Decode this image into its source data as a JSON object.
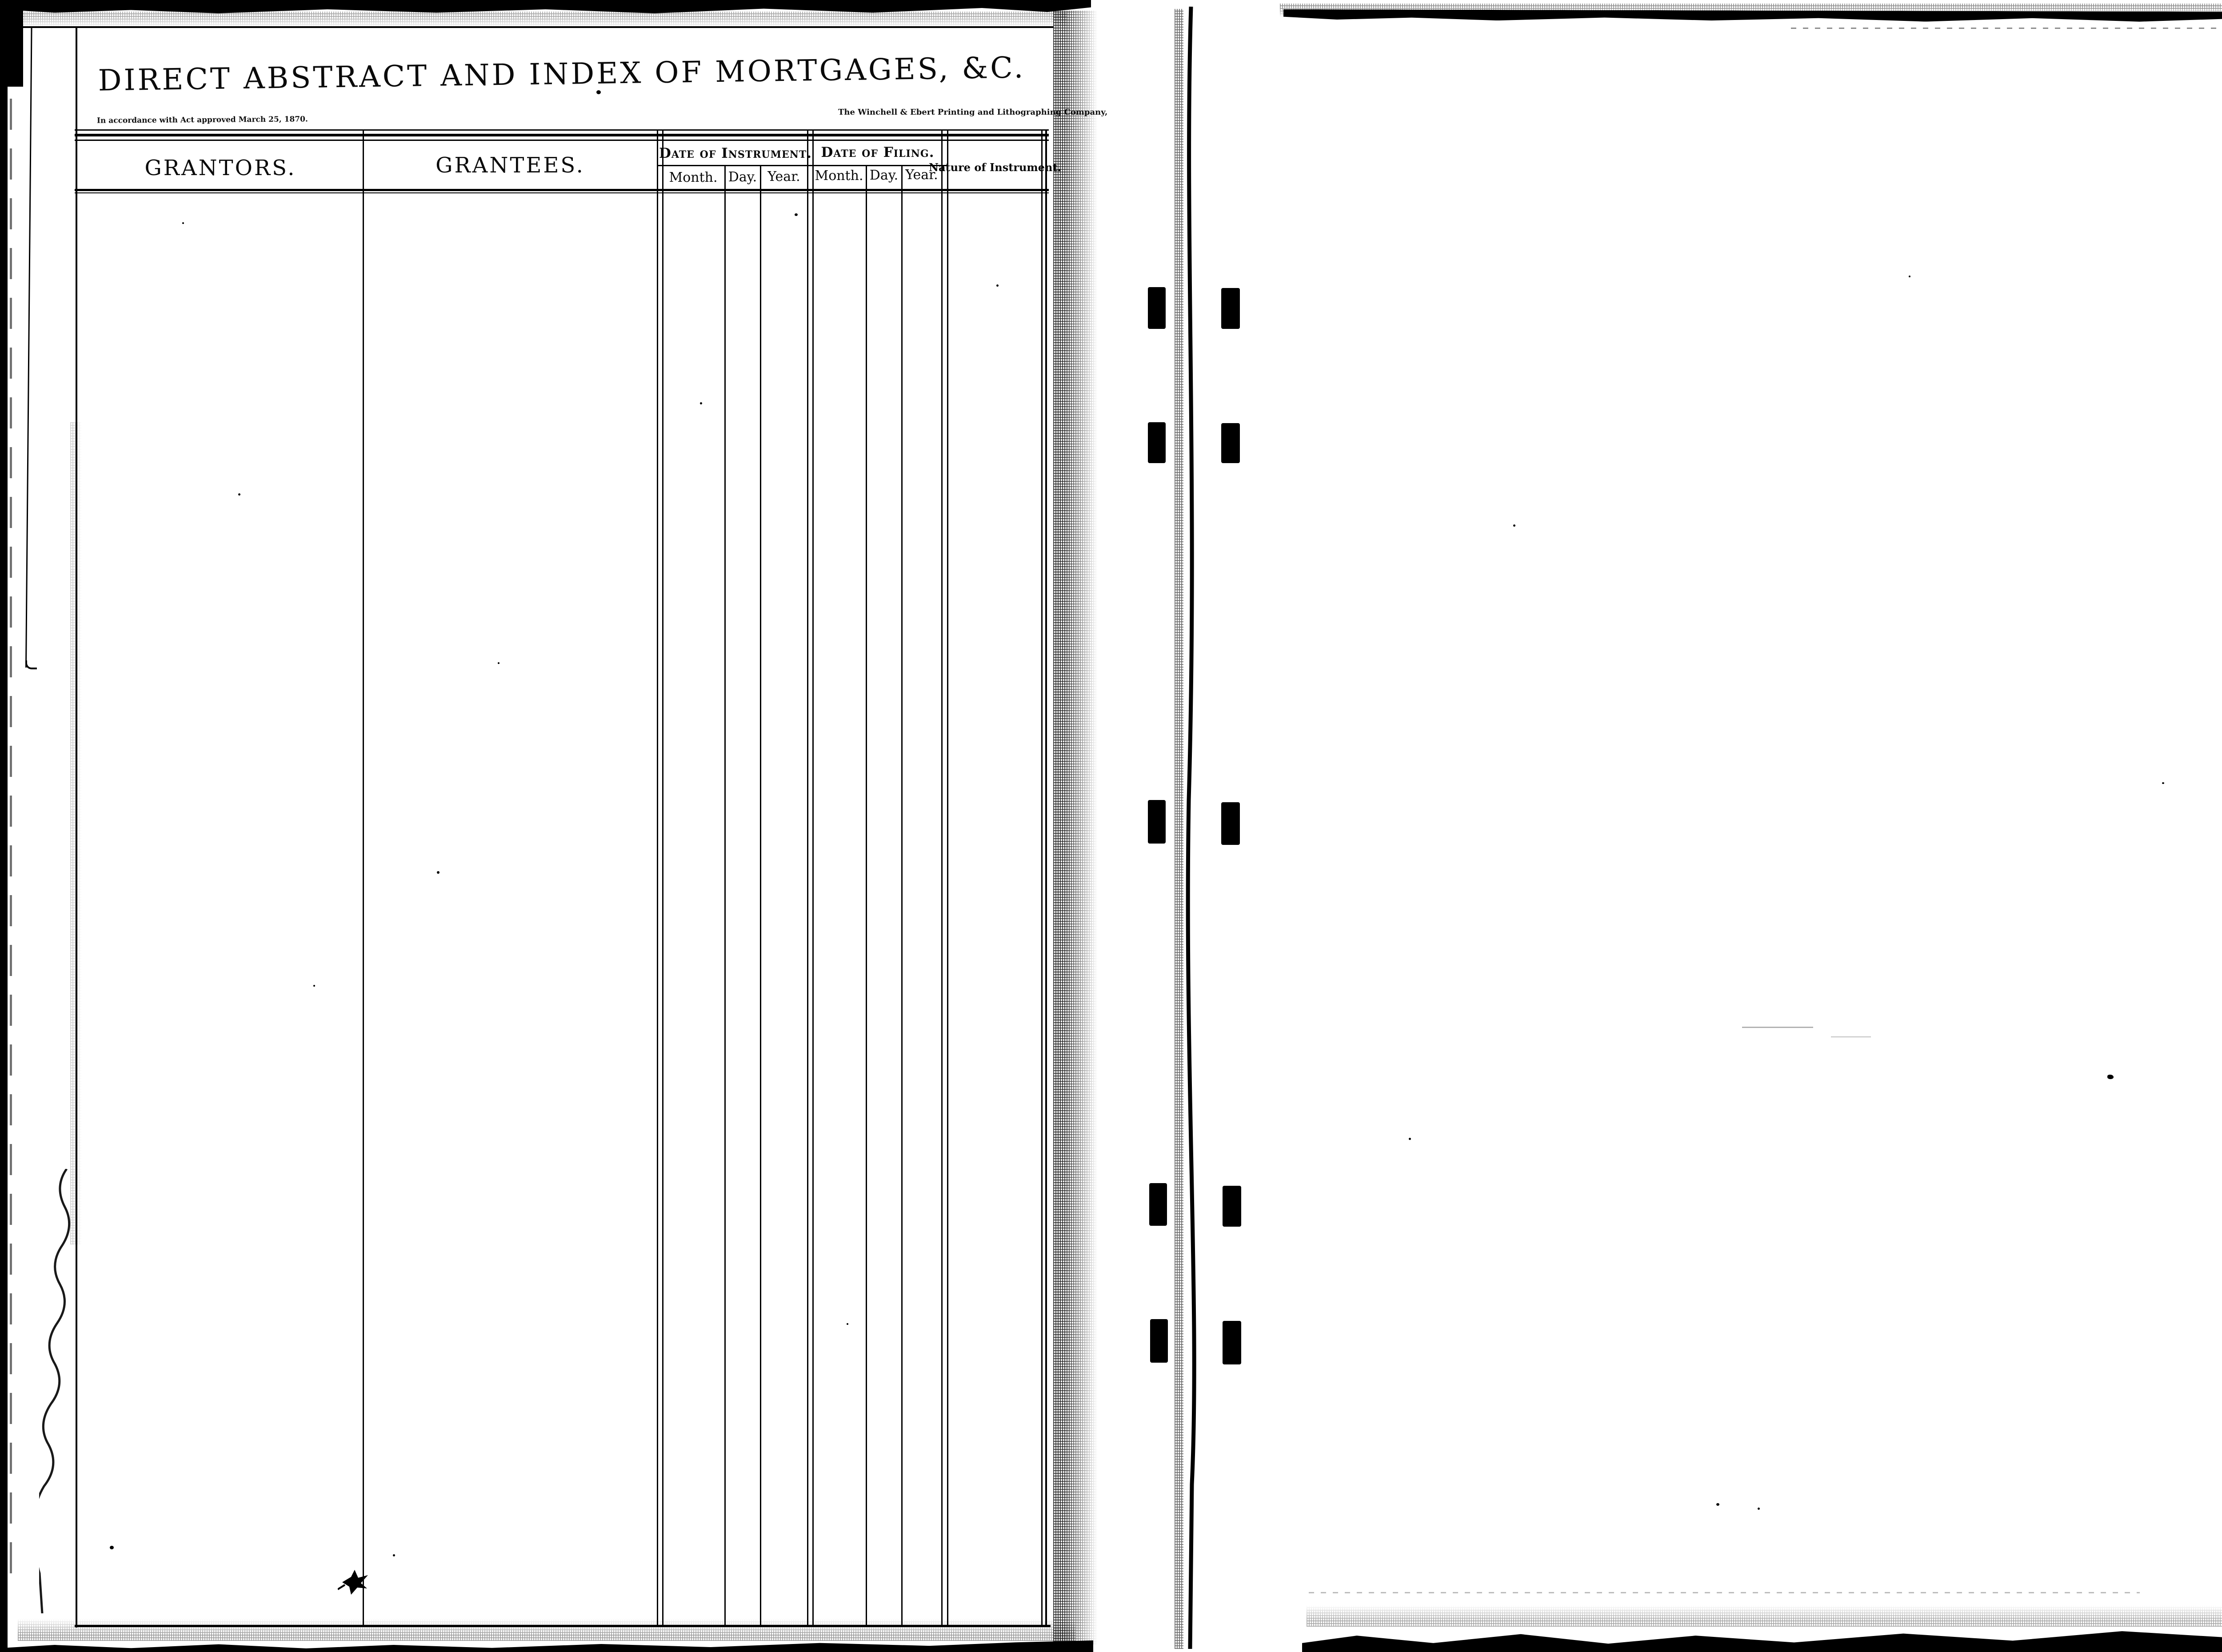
{
  "document": {
    "title": "DIRECT ABSTRACT AND INDEX OF MORTGAGES, &C.",
    "act_note": "In accordance with Act approved March 25, 1870.",
    "printer_credit": "The Winchell & Ebert Printing and Lithographing Company,"
  },
  "table": {
    "grantors_header": "GRANTORS.",
    "grantees_header": "GRANTEES.",
    "date_groups": [
      {
        "label": "Date of Instrument.",
        "subcolumns": [
          "Month.",
          "Day.",
          "Year."
        ]
      },
      {
        "label": "Date of Filing.",
        "subcolumns": [
          "Month.",
          "Day.",
          "Year."
        ]
      }
    ],
    "nature_header": "Nature of Instrument.",
    "rows": []
  },
  "colors": {
    "ink": "#000000",
    "paper": "#ffffff",
    "scan_background": "#000000"
  }
}
